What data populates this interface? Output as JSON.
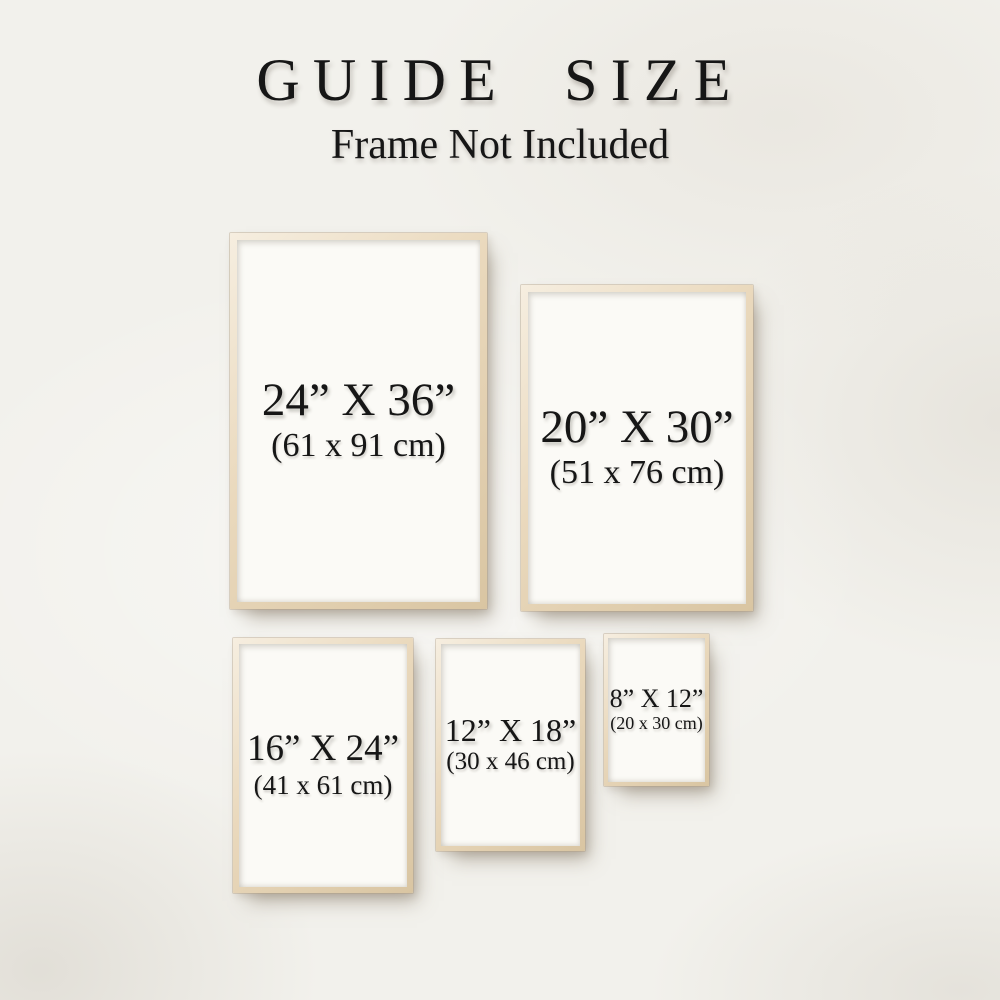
{
  "header": {
    "title": "GUIDE SIZE",
    "subtitle": "Frame Not Included"
  },
  "frames": [
    {
      "name": "24x36",
      "inches": "24” X 36”",
      "cm": "(61 x 91 cm)"
    },
    {
      "name": "20x30",
      "inches": "20” X 30”",
      "cm": "(51 x 76 cm)"
    },
    {
      "name": "16x24",
      "inches": "16” X 24”",
      "cm": "(41 x 61 cm)"
    },
    {
      "name": "12x18",
      "inches": "12” X 18”",
      "cm": "(30 x 46 cm)"
    },
    {
      "name": "8x12",
      "inches": "8” X 12”",
      "cm": "(20 x 30 cm)"
    }
  ],
  "colors": {
    "background": "#f2f1ec",
    "frame_wood": "#e6d7bc",
    "poster_white": "#fbfaf6",
    "text": "#161616"
  }
}
